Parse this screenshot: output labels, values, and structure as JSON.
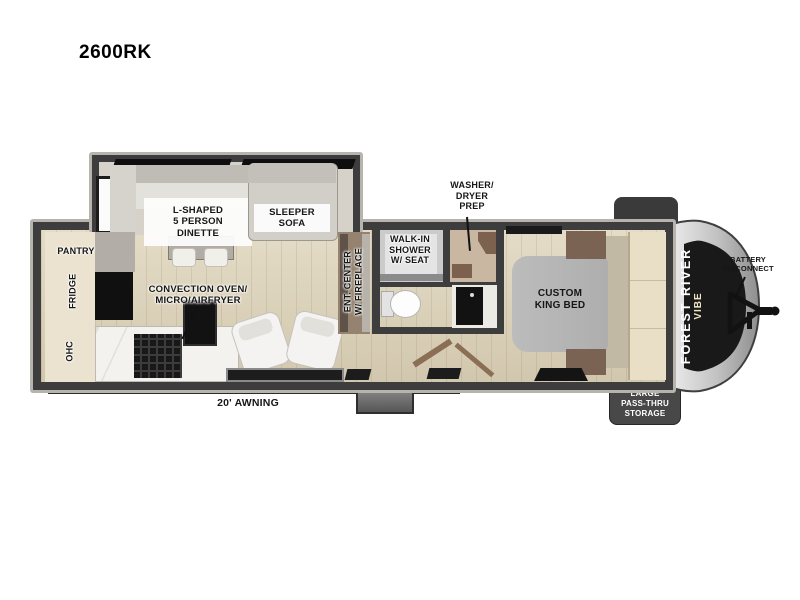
{
  "title": "2600RK",
  "rooms": {
    "pantry": "PANTRY",
    "fridge": "FRIDGE",
    "ohc": "OHC",
    "dinette": "L-SHAPED\n5 PERSON\nDINETTE",
    "sleeper_sofa": "SLEEPER\nSOFA",
    "convection_oven": "CONVECTION OVEN/\nMICRO/AIRFRYER",
    "ent_center": "ENT. CENTER\nW/ FIREPLACE",
    "walk_in_shower": "WALK-IN\nSHOWER\nW/ SEAT",
    "washer_dryer": "WASHER/\nDRYER\nPREP",
    "king_bed": "CUSTOM\nKING BED"
  },
  "exterior": {
    "awning": "20' AWNING",
    "battery_disconnect": "BATTERY\nDISCONNECT",
    "pass_thru_storage": "LARGE\nPASS-THRU\nSTORAGE",
    "brand_line1": "FOREST RIVER",
    "brand_line2": "VIBE"
  },
  "colors": {
    "wall": "#3d3d3d",
    "wall_trim": "#b6b4ad",
    "floor": "#ddd2b7",
    "cabinet_cream": "#ebe2cf",
    "appliance_black": "#111111",
    "bed_gray": "#b6b6b6",
    "wood_accent": "#7b6353",
    "storage_box": "#484848",
    "cap_silver": "#c9c9c9",
    "cap_panel": "#191919"
  }
}
